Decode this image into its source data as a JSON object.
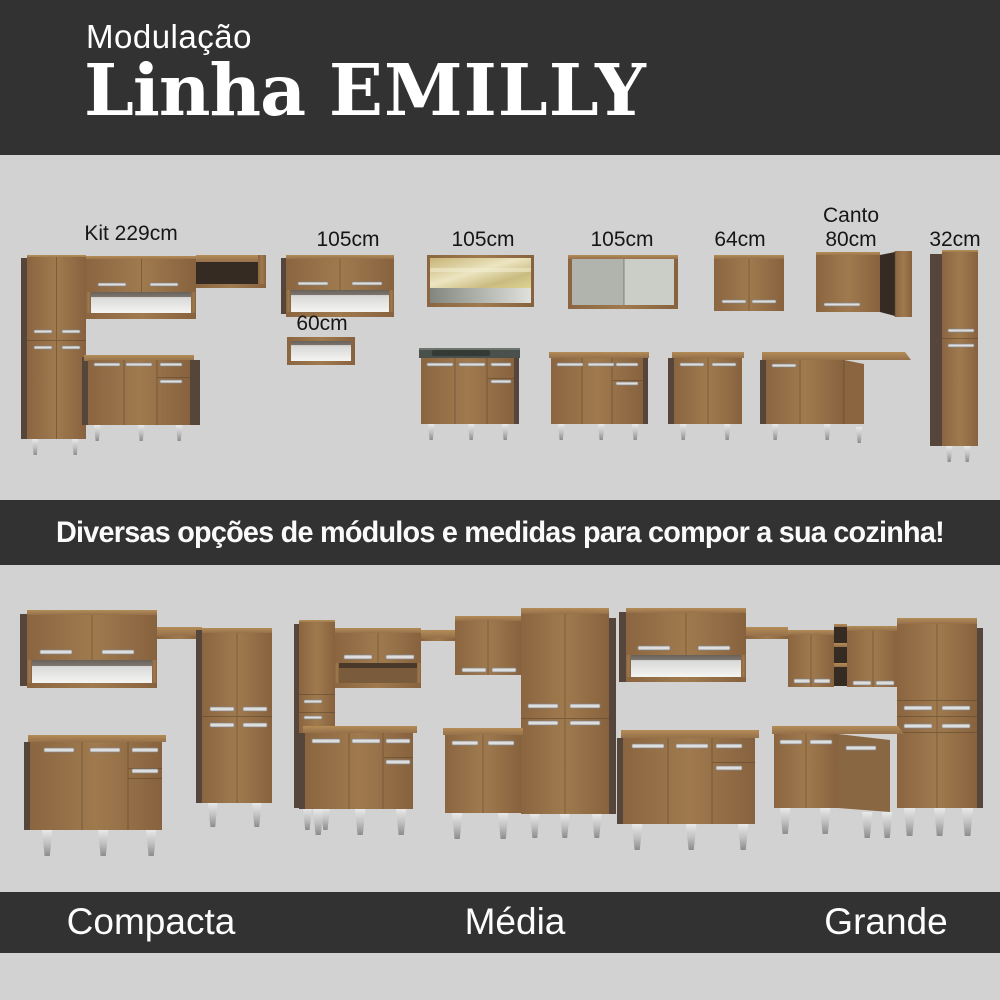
{
  "header": {
    "kicker": "Modulação",
    "title_prefix": "Linha",
    "title_emphasis": "EMILLY"
  },
  "module_labels": {
    "kit229": "Kit 229cm",
    "upper105": "105cm",
    "shelf60": "60cm",
    "glass105": "105cm",
    "sliding105": "105cm",
    "upper64": "64cm",
    "canto_line1": "Canto",
    "canto_line2": "80cm",
    "tall32": "32cm"
  },
  "banner": {
    "text": "Diversas opções de módulos e medidas para compor a sua cozinha!"
  },
  "kitchens": {
    "compacta": "Compacta",
    "media": "Média",
    "grande": "Grande"
  },
  "colors": {
    "background": "#d2d2d2",
    "band": "#323232",
    "wood": "#96714a",
    "wood_light": "#b08a55",
    "side_panel": "#56453a",
    "handle": "#dedede",
    "counter": "#4a504b",
    "glass": "#d8c98f",
    "text_light": "#ffffff",
    "text_dark": "#161616"
  }
}
